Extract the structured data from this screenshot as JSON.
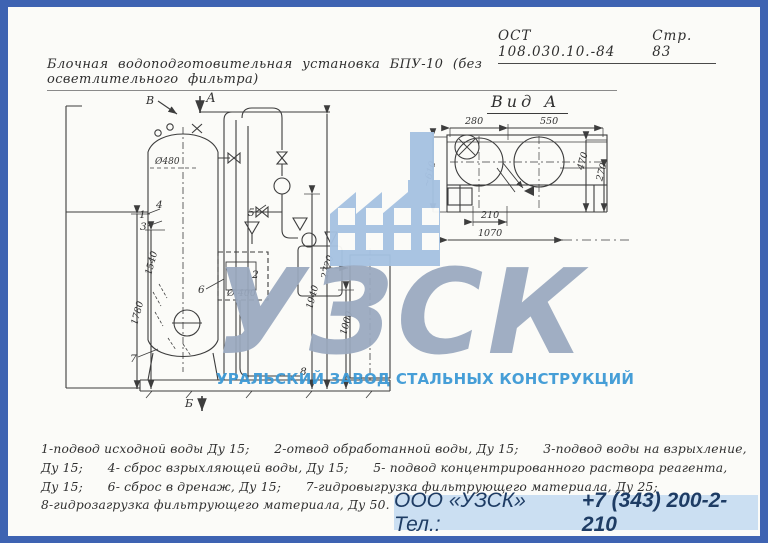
{
  "document": {
    "header": {
      "standard_ref": "ОСТ 108.030.10.-84",
      "page_number": "Стр. 83"
    },
    "title": "Блочная водоподготовительная установка БПУ-10 (без осветлительного фильтра)"
  },
  "main_view": {
    "dims": {
      "tank_diameter": "Ø480",
      "vessel_diameter": "Ø 400",
      "left_inner": "1540",
      "left_outer": "1780",
      "right_mid": "1940",
      "right_low": "1000",
      "right_total": "2720"
    },
    "markers": {
      "view_a_arrow": "А",
      "marker_b": "В",
      "marker_bottom": "Б"
    },
    "callouts": [
      "1",
      "2",
      "3",
      "4",
      "5",
      "6",
      "7",
      "8"
    ]
  },
  "view_a": {
    "label": "Вид А",
    "dims": {
      "top_left": "280",
      "top_right": "550",
      "left": "~610",
      "right_outer": "470",
      "right_inner": "270",
      "bottom_inner": "210",
      "bottom_total": "1070"
    }
  },
  "legend": {
    "lines": [
      "1-подвод исходной воды Ду 15;      2-отвод обработанной воды, Ду 15;      3-подвод воды на взрыхление,",
      "Ду 15;      4- сброс взрыхляющей воды, Ду 15;      5- подвод концентрированного раствора реагента,",
      "Ду 15;      6- сброс в дренаж, Ду 15;      7-гидровыгрузка фильтрующего материала, Ду 25;",
      "8-гидрозагрузка фильтрующего материала, Ду 50."
    ]
  },
  "watermark": {
    "acronym": "УЗСК",
    "company_name": "УРАЛЬСКИЙ ЗАВОД СТАЛЬНЫХ КОНСТРУКЦИЙ"
  },
  "footer": {
    "company_label": "ООО «УЗСК» Тел.:",
    "phone": "+7 (343) 200-2-210"
  },
  "colors": {
    "border": "#3e63b2",
    "paper": "#fbfbf8",
    "ink": "#3d3d3d",
    "watermark_icon": "#a6c2e2",
    "watermark_acronym": "#9aa9bf",
    "watermark_company": "#3d9ad6",
    "footer_bg": "#cbdff2",
    "footer_text": "#1e3c64"
  }
}
